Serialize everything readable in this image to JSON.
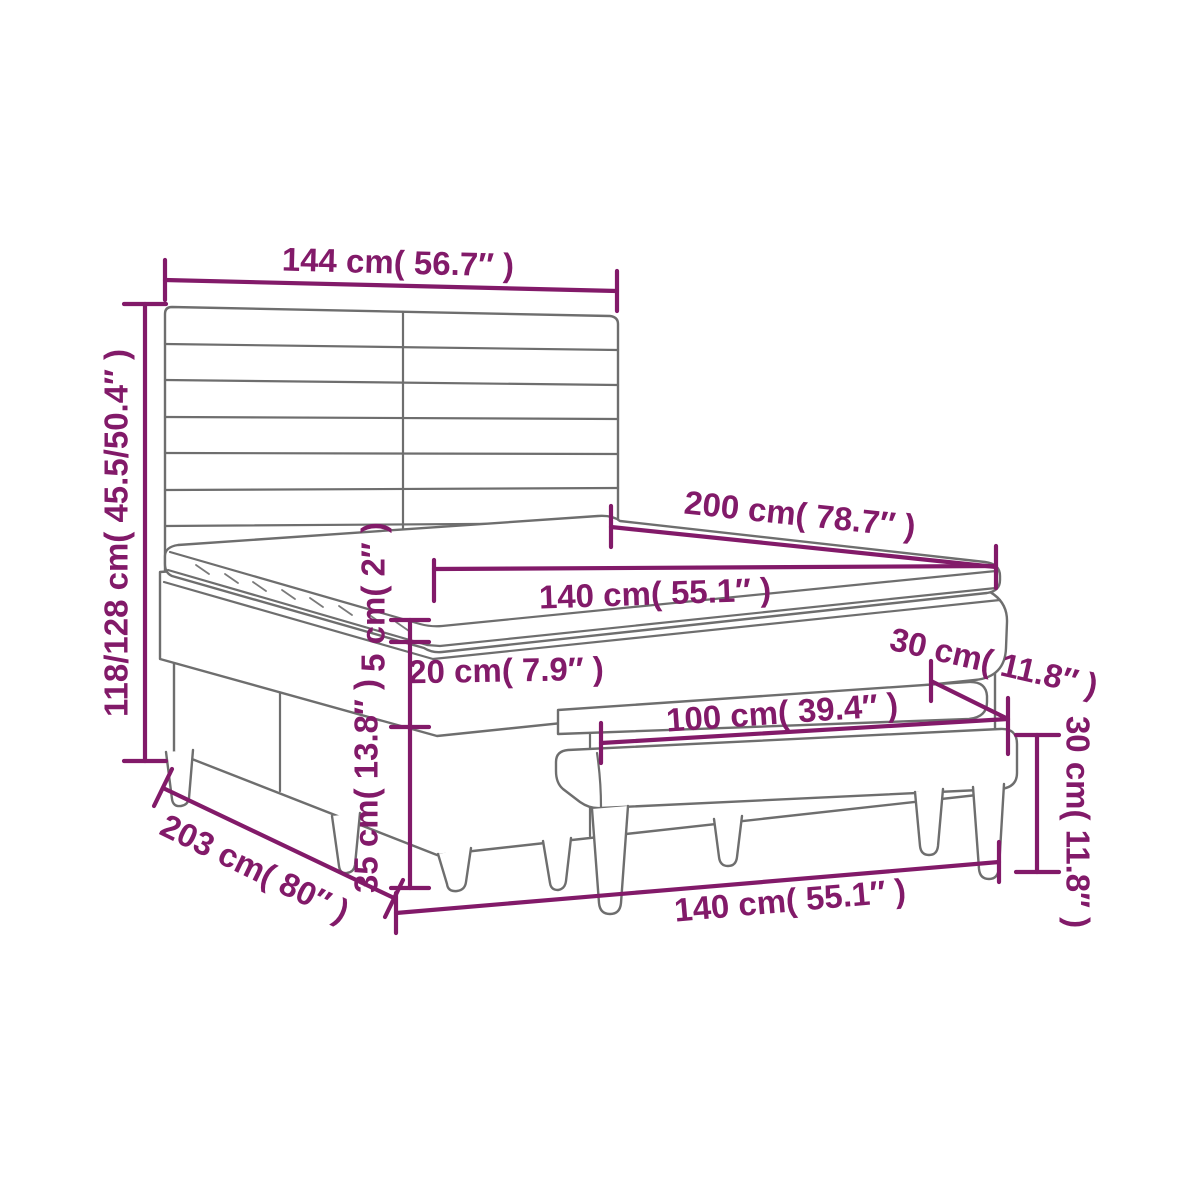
{
  "diagram": {
    "subject": "box spring bed with slatted headboard, mattress topper and upholstered bench",
    "colors": {
      "annotation": "#821a69",
      "line_art": "#6e6e6e",
      "background": "#ffffff"
    },
    "annotations": {
      "headboard_width": "144 cm( 56.7″ )",
      "headboard_height": "118/128 cm( 45.5/50.4″ )",
      "bed_length": "200 cm( 78.7″ )",
      "mattress_width": "140 cm( 55.1″ )",
      "topper_thickness": "5 cm( 2″ )",
      "mattress_thickness": "20 cm( 7.9″ )",
      "base_height": "35 cm( 13.8″ )",
      "frame_length": "203 cm( 80″ )",
      "bench_seat_width": "100 cm( 39.4″ )",
      "bench_depth": "30 cm( 11.8″ )",
      "bench_height": "30 cm( 11.8″ )",
      "bed_width": "140 cm( 55.1″ )"
    }
  }
}
